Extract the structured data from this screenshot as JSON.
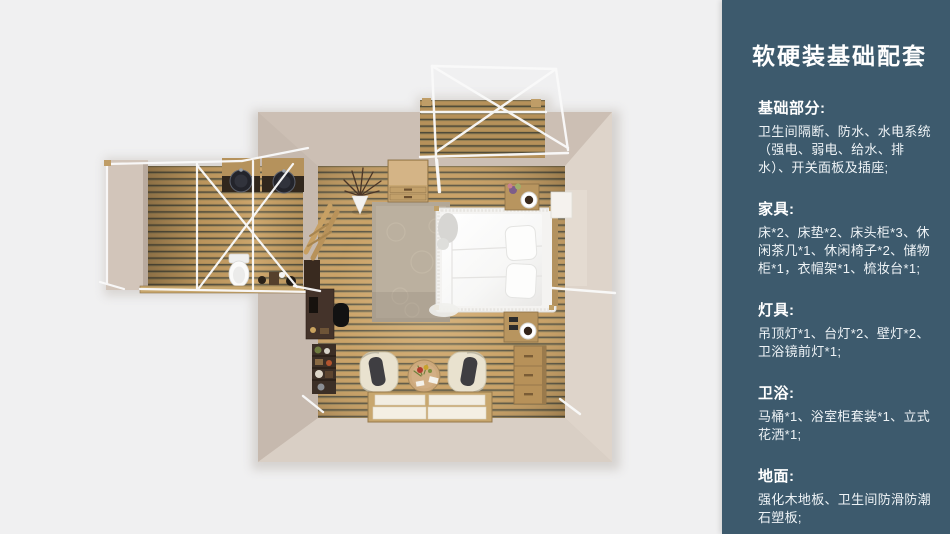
{
  "page": {
    "background_color": "#f0f0f1"
  },
  "floorplan": {
    "colors": {
      "wood_floor": "#c79e62",
      "wall_taupe": "#d3c7bc",
      "frame_white": "#fafafa",
      "bed_white": "#f6f5f3",
      "dark_counter": "#31271d"
    }
  },
  "panel": {
    "background_color": "#3d5a6d",
    "text_color": "#ffffff",
    "title": "软硬装基础配套",
    "sections": [
      {
        "heading": "基础部分:",
        "body": "卫生间隔断、防水、水电系统（强电、弱电、给水、排水）、开关面板及插座;"
      },
      {
        "heading": "家具:",
        "body": "床*2、床垫*2、床头柜*3、休闲茶几*1、休闲椅子*2、储物柜*1，衣帽架*1、梳妆台*1;"
      },
      {
        "heading": "灯具:",
        "body": "吊顶灯*1、台灯*2、壁灯*2、卫浴镜前灯*1;"
      },
      {
        "heading": "卫浴:",
        "body": "马桶*1、浴室柜套装*1、立式花洒*1;"
      },
      {
        "heading": "地面:",
        "body": "强化木地板、卫生间防滑防潮石塑板;"
      }
    ]
  }
}
